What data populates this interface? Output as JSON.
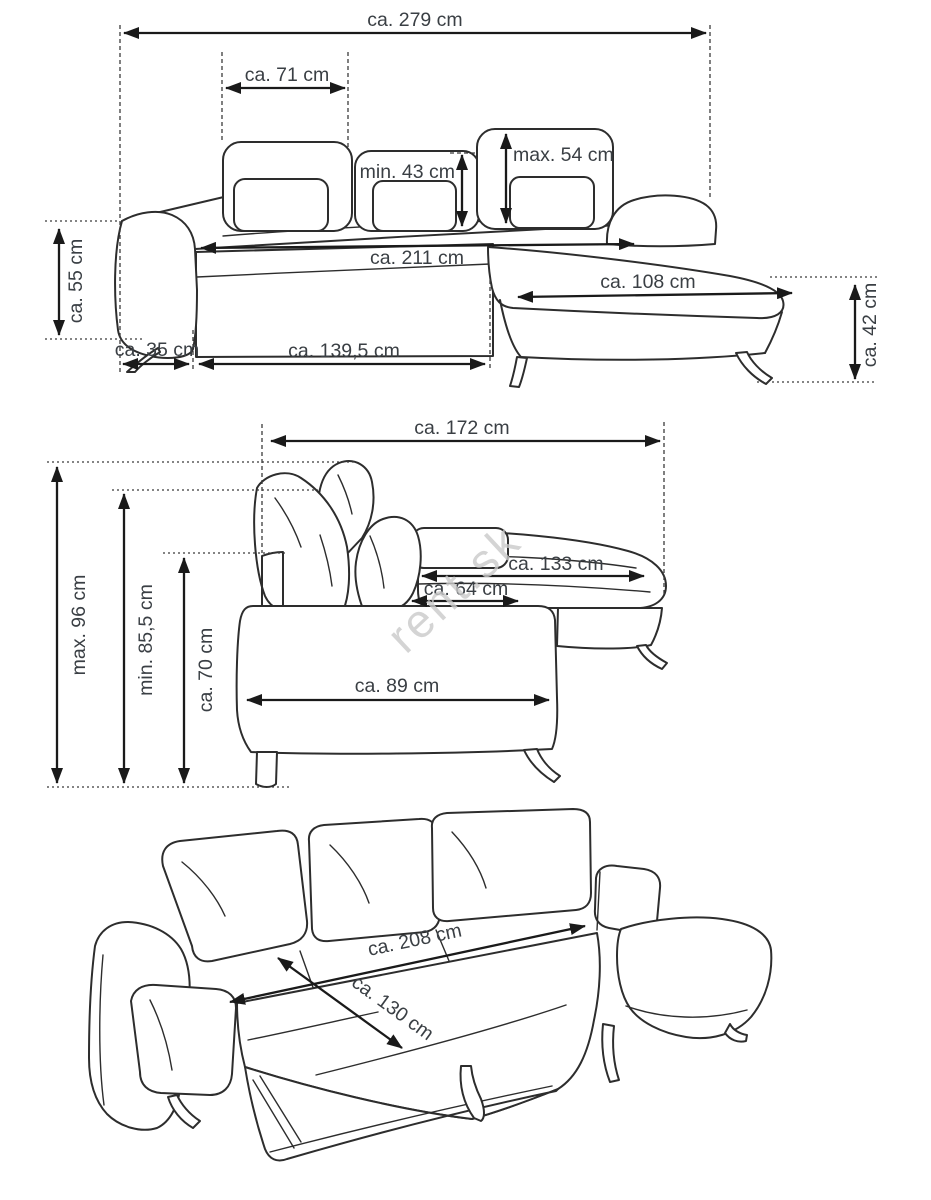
{
  "watermark": "rent.sk",
  "colors": {
    "line": "#2d2d2d",
    "dimension_line": "#1a1a1a",
    "label_text": "#3a3f44",
    "watermark": "#cacaca",
    "background": "#ffffff"
  },
  "views": {
    "front": {
      "title": "corner sofa front view",
      "labels": {
        "total_width": "ca. 279 cm",
        "headrest_width": "ca. 71 cm",
        "headrest_min_height": "min. 43 cm",
        "headrest_max_height": "max. 54 cm",
        "seat_height": "ca. 55 cm",
        "seat_width": "ca. 211 cm",
        "chaise_width": "ca. 108 cm",
        "chaise_height": "ca. 42 cm",
        "armrest_width": "ca. 35 cm",
        "front_section_width": "ca. 139,5 cm"
      }
    },
    "side": {
      "title": "corner sofa side view",
      "labels": {
        "total_depth": "ca. 172 cm",
        "max_height": "max. 96 cm",
        "min_height": "min. 85,5 cm",
        "backrest_height": "ca. 70 cm",
        "chaise_depth": "ca. 133 cm",
        "upper_seat_depth": "ca. 64 cm",
        "seat_depth": "ca. 89 cm"
      }
    },
    "bed": {
      "title": "sofa bed unfolded perspective view",
      "labels": {
        "bed_length": "ca. 208 cm",
        "bed_width": "ca. 130 cm"
      }
    }
  }
}
